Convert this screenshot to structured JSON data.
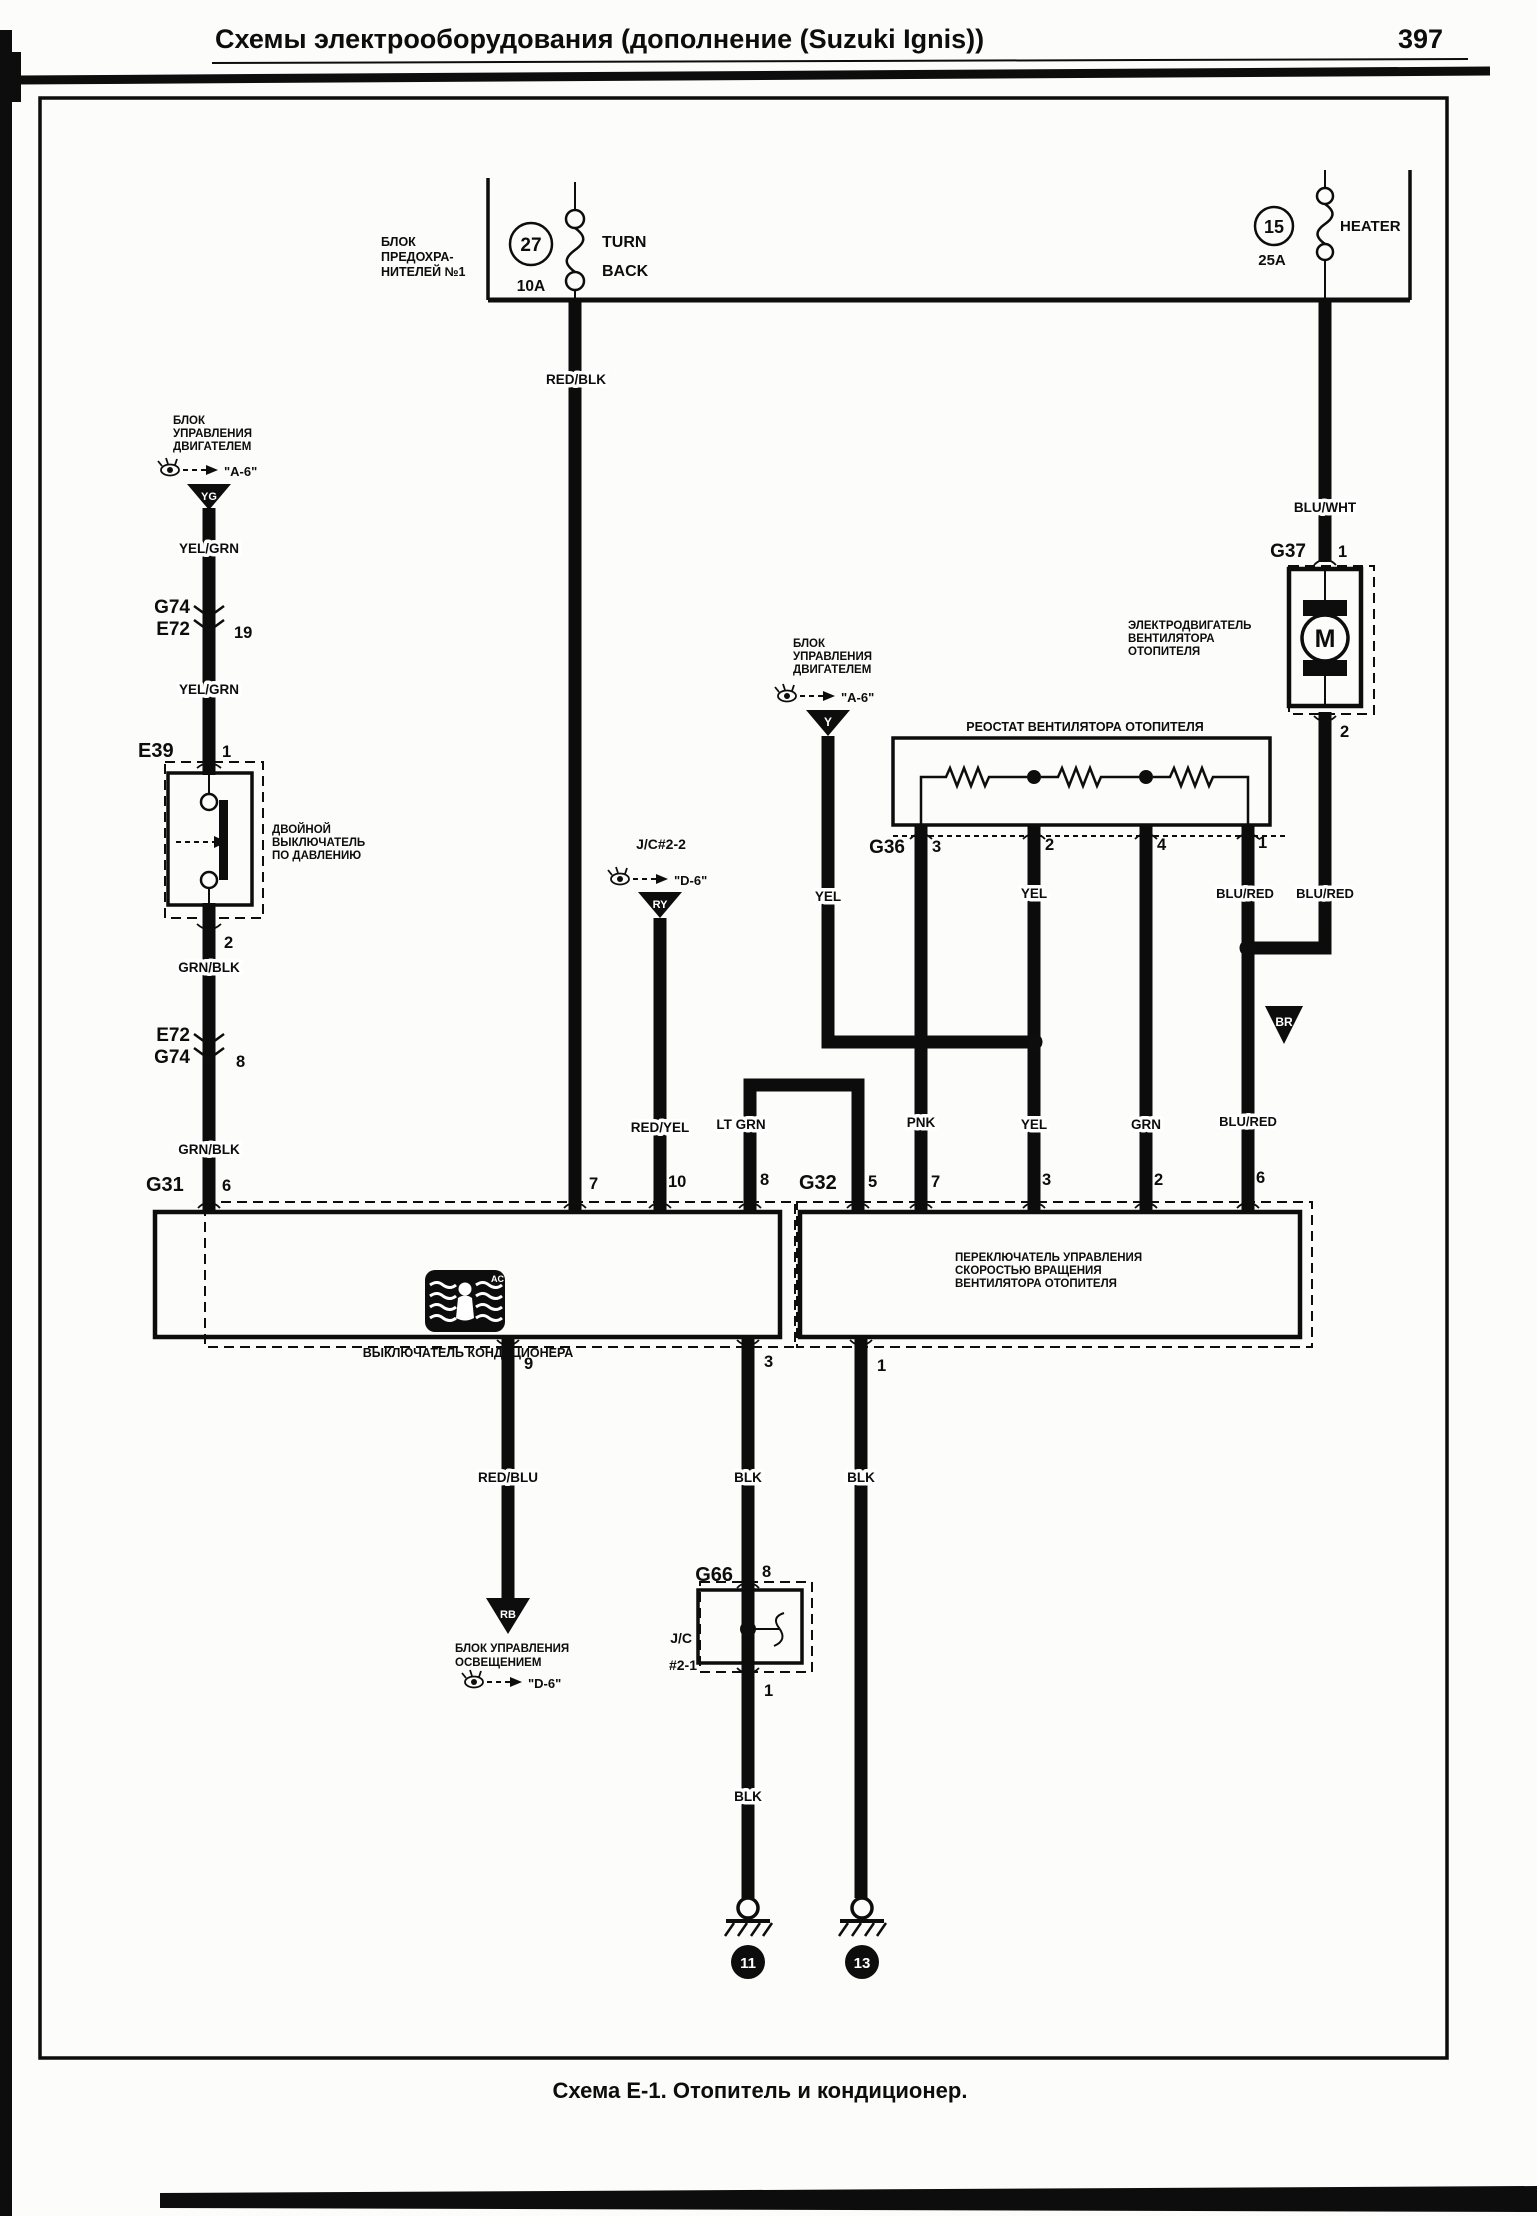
{
  "header": {
    "title": "Схемы электрооборудования (дополнение (Suzuki Ignis))",
    "page_number": "397"
  },
  "caption": "Схема Е-1. Отопитель и кондиционер.",
  "fuse_block": {
    "label_lines": [
      "БЛОК",
      "ПРЕДОХРА-",
      "НИТЕЛЕЙ №1"
    ],
    "fuse_27": {
      "number": "27",
      "amp": "10A",
      "name_line1": "TURN",
      "name_line2": "BACK"
    },
    "fuse_15": {
      "number": "15",
      "amp": "25A",
      "name": "HEATER"
    }
  },
  "ecu_left": {
    "lines": [
      "БЛОК",
      "УПРАВЛЕНИЯ",
      "ДВИГАТЕЛЕМ"
    ],
    "ref": "\"A-6\"",
    "code": "YG"
  },
  "ecu_mid": {
    "lines": [
      "БЛОК",
      "УПРАВЛЕНИЯ",
      "ДВИГАТЕЛЕМ"
    ],
    "ref": "\"A-6\"",
    "code": "Y"
  },
  "jc22": {
    "name": "J/C#2-2",
    "ref": "\"D-6\"",
    "code": "RY"
  },
  "lighting": {
    "lines": [
      "БЛОК УПРАВЛЕНИЯ",
      "ОСВЕЩЕНИЕМ"
    ],
    "ref": "\"D-6\"",
    "code": "RB"
  },
  "br_splice": "BR",
  "connectors": {
    "g74_e72": {
      "a": "G74",
      "b": "E72",
      "pin": "19"
    },
    "e39": {
      "name": "E39",
      "pin_in": "1",
      "pin_out": "2"
    },
    "e72_g74": {
      "a": "E72",
      "b": "G74",
      "pin": "8"
    },
    "g31": {
      "name": "G31",
      "pin6": "6",
      "pin7": "7",
      "pin10": "10",
      "pin8": "8",
      "pin9": "9",
      "pin3": "3"
    },
    "g36": {
      "name": "G36",
      "p3": "3",
      "p2": "2",
      "p4": "4",
      "p1": "1"
    },
    "g32": {
      "name": "G32",
      "p5": "5",
      "p7": "7",
      "p3": "3",
      "p2": "2",
      "p6": "6",
      "p1": "1"
    },
    "g37": {
      "name": "G37",
      "p1": "1",
      "p2": "2"
    },
    "g66": {
      "name": "G66",
      "p8": "8",
      "p1": "1"
    }
  },
  "components": {
    "pressure_switch_lines": [
      "ДВОЙНОЙ",
      "ВЫКЛЮЧАТЕЛЬ",
      "ПО ДАВЛЕНИЮ"
    ],
    "resistor_label": "РЕОСТАТ ВЕНТИЛЯТОРА ОТОПИТЕЛЯ",
    "motor_lines": [
      "ЭЛЕКТРОДВИГАТЕЛЬ",
      "ВЕНТИЛЯТОРА",
      "ОТОПИТЕЛЯ"
    ],
    "motor_symbol": "M",
    "ac_switch_label": "ВЫКЛЮЧАТЕЛЬ КОНДИЦИОНЕРА",
    "ac_icon_text": "AC",
    "blower_switch_lines": [
      "ПЕРЕКЛЮЧАТЕЛЬ УПРАВЛЕНИЯ",
      "СКОРОСТЬЮ ВРАЩЕНИЯ",
      "ВЕНТИЛЯТОРА ОТОПИТЕЛЯ"
    ],
    "jc21_line1": "J/C",
    "jc21_line2": "#2-1"
  },
  "wire_labels": {
    "red_blk": "RED/BLK",
    "yel_grn_1": "YEL/GRN",
    "yel_grn_2": "YEL/GRN",
    "grn_blk_1": "GRN/BLK",
    "grn_blk_2": "GRN/BLK",
    "blu_wht": "BLU/WHT",
    "yel_ecu": "YEL",
    "yel_res": "YEL",
    "blu_red_left": "BLU/RED",
    "blu_red_right": "BLU/RED",
    "blu_red_mid": "BLU/RED",
    "red_yel": "RED/YEL",
    "lt_grn": "LT GRN",
    "pnk": "PNK",
    "yel_mid": "YEL",
    "grn": "GRN",
    "red_blu": "RED/BLU",
    "blk_1": "BLK",
    "blk_2": "BLK",
    "blk_3": "BLK"
  },
  "grounds": {
    "g11": "11",
    "g13": "13"
  }
}
